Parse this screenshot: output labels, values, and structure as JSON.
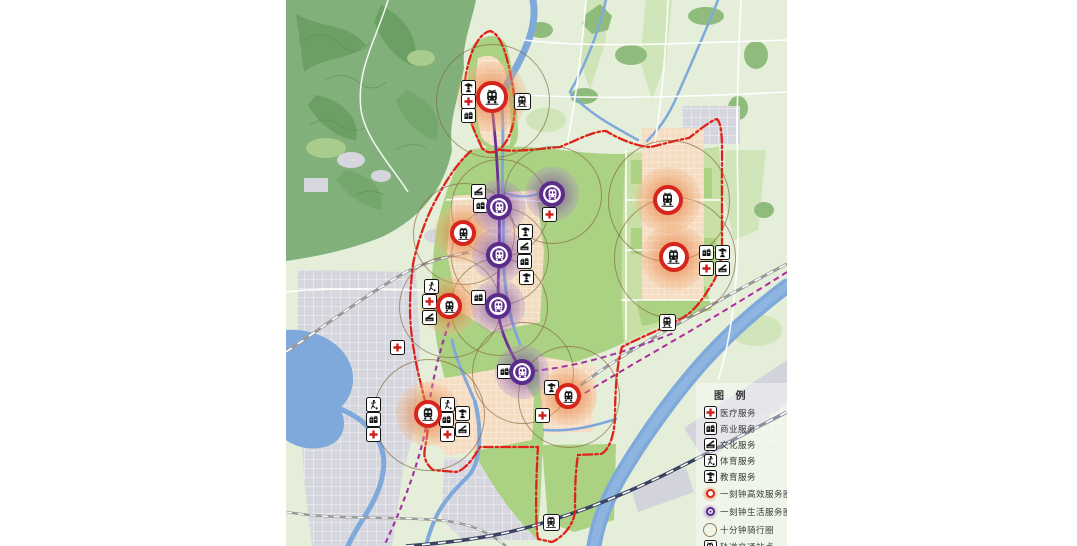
{
  "legend": {
    "title": "图 例",
    "items": [
      {
        "id": "medical",
        "label": "医疗服务",
        "type": "icon"
      },
      {
        "id": "commercial",
        "label": "商业服务",
        "type": "icon"
      },
      {
        "id": "culture",
        "label": "文化服务",
        "type": "icon"
      },
      {
        "id": "sports",
        "label": "体育服务",
        "type": "icon"
      },
      {
        "id": "education",
        "label": "教育服务",
        "type": "icon"
      },
      {
        "id": "efficient",
        "label": "一刻钟高效服务圈",
        "type": "marker-efficient"
      },
      {
        "id": "life",
        "label": "一刻钟生活服务圈",
        "type": "marker-life"
      },
      {
        "id": "cycling",
        "label": "十分钟骑行圈",
        "type": "ring"
      },
      {
        "id": "station",
        "label": "轨道交通站点",
        "type": "station"
      }
    ]
  },
  "colors": {
    "boundary_red": "#e0231a",
    "efficient_ring": "#d6251d",
    "efficient_glow": "#e8763a",
    "life_ring": "#5b2d8b",
    "life_glow": "#9a6cc0",
    "cycling_ring": "#806238",
    "metro_purple": "#6a2f96",
    "metro_magenta": "#b02ba0",
    "medical_red": "#cf1f1a",
    "water_blue": "#7fa9da",
    "park_green": "#abd182",
    "mountain_green": "#82b07a",
    "urban_gray": "#d6d7de",
    "residential_peach": "#f6dcc0",
    "rail_navy": "#39425f"
  },
  "map": {
    "cycling_circles": [
      [
        206,
        100,
        56
      ],
      [
        177,
        233,
        50
      ],
      [
        213,
        207,
        48
      ],
      [
        266,
        194,
        48
      ],
      [
        213,
        255,
        48
      ],
      [
        163,
        306,
        50
      ],
      [
        212,
        306,
        48
      ],
      [
        142,
        414,
        55
      ],
      [
        236,
        372,
        50
      ],
      [
        282,
        396,
        50
      ],
      [
        382,
        200,
        60
      ],
      [
        388,
        257,
        60
      ]
    ],
    "efficient_markers": [
      {
        "x": 206,
        "y": 97,
        "s": 1.2
      },
      {
        "x": 177,
        "y": 233,
        "s": 1
      },
      {
        "x": 163,
        "y": 306,
        "s": 1
      },
      {
        "x": 142,
        "y": 414,
        "s": 1.1
      },
      {
        "x": 282,
        "y": 396,
        "s": 1
      },
      {
        "x": 382,
        "y": 200,
        "s": 1.15
      },
      {
        "x": 388,
        "y": 257,
        "s": 1.15
      }
    ],
    "life_markers": [
      {
        "x": 213,
        "y": 207,
        "s": 1
      },
      {
        "x": 266,
        "y": 194,
        "s": 1
      },
      {
        "x": 213,
        "y": 255,
        "s": 1
      },
      {
        "x": 212,
        "y": 306,
        "s": 1
      },
      {
        "x": 236,
        "y": 372,
        "s": 1
      }
    ],
    "rail_stations": [
      {
        "x": 236,
        "y": 101
      },
      {
        "x": 381,
        "y": 322
      },
      {
        "x": 265,
        "y": 522
      }
    ],
    "service_badges": [
      {
        "t": "education",
        "x": 182,
        "y": 87
      },
      {
        "t": "medical",
        "x": 182,
        "y": 101
      },
      {
        "t": "commercial",
        "x": 182,
        "y": 115
      },
      {
        "t": "culture",
        "x": 192,
        "y": 191
      },
      {
        "t": "commercial",
        "x": 194,
        "y": 205
      },
      {
        "t": "medical",
        "x": 263,
        "y": 214
      },
      {
        "t": "education",
        "x": 239,
        "y": 231
      },
      {
        "t": "culture",
        "x": 238,
        "y": 246
      },
      {
        "t": "commercial",
        "x": 238,
        "y": 261
      },
      {
        "t": "education",
        "x": 240,
        "y": 277
      },
      {
        "t": "sports",
        "x": 145,
        "y": 286
      },
      {
        "t": "medical",
        "x": 143,
        "y": 301
      },
      {
        "t": "culture",
        "x": 143,
        "y": 317
      },
      {
        "t": "commercial",
        "x": 192,
        "y": 297
      },
      {
        "t": "medical",
        "x": 111,
        "y": 347
      },
      {
        "t": "sports",
        "x": 87,
        "y": 404
      },
      {
        "t": "commercial",
        "x": 87,
        "y": 419
      },
      {
        "t": "medical",
        "x": 87,
        "y": 434
      },
      {
        "t": "sports",
        "x": 161,
        "y": 404
      },
      {
        "t": "commercial",
        "x": 160,
        "y": 419
      },
      {
        "t": "medical",
        "x": 161,
        "y": 434
      },
      {
        "t": "education",
        "x": 176,
        "y": 413
      },
      {
        "t": "culture",
        "x": 176,
        "y": 429
      },
      {
        "t": "commercial",
        "x": 218,
        "y": 371
      },
      {
        "t": "education",
        "x": 265,
        "y": 387
      },
      {
        "t": "medical",
        "x": 256,
        "y": 415
      },
      {
        "t": "commercial",
        "x": 420,
        "y": 252
      },
      {
        "t": "education",
        "x": 436,
        "y": 252
      },
      {
        "t": "medical",
        "x": 420,
        "y": 268
      },
      {
        "t": "culture",
        "x": 436,
        "y": 268
      }
    ]
  }
}
